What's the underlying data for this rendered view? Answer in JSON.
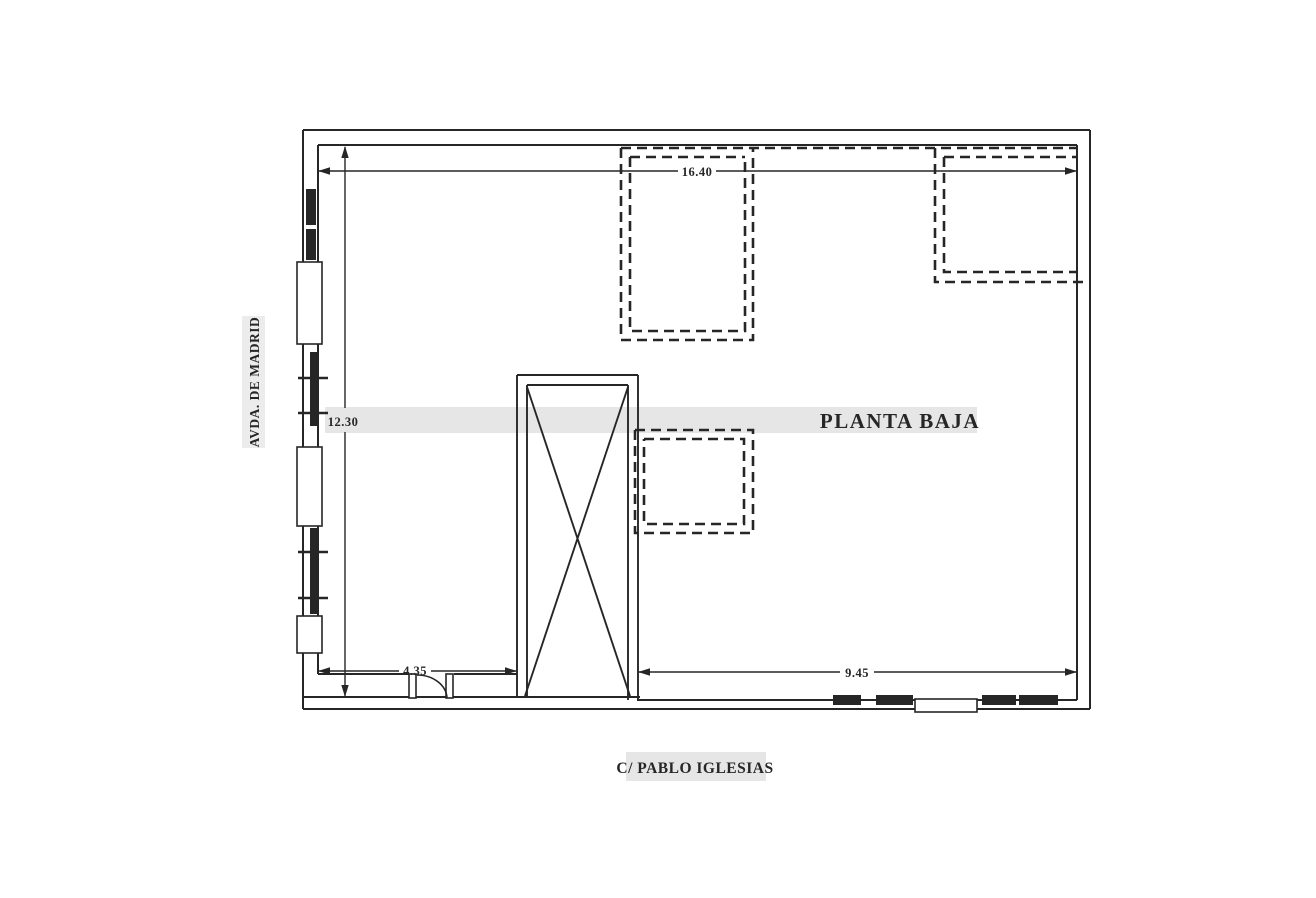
{
  "plan": {
    "title": "PLANTA BAJA",
    "streets": {
      "left": "AVDA. DE MADRID",
      "bottom": "C/ PABLO IGLESIAS"
    },
    "dimensions": {
      "top": "16.40",
      "left": "12.30",
      "bottom_left": "4.35",
      "bottom_right": "9.45"
    },
    "colors": {
      "line": "#262626",
      "highlight_band": "#e6e6e6",
      "side_band": "#ececec",
      "background": "#ffffff"
    }
  }
}
